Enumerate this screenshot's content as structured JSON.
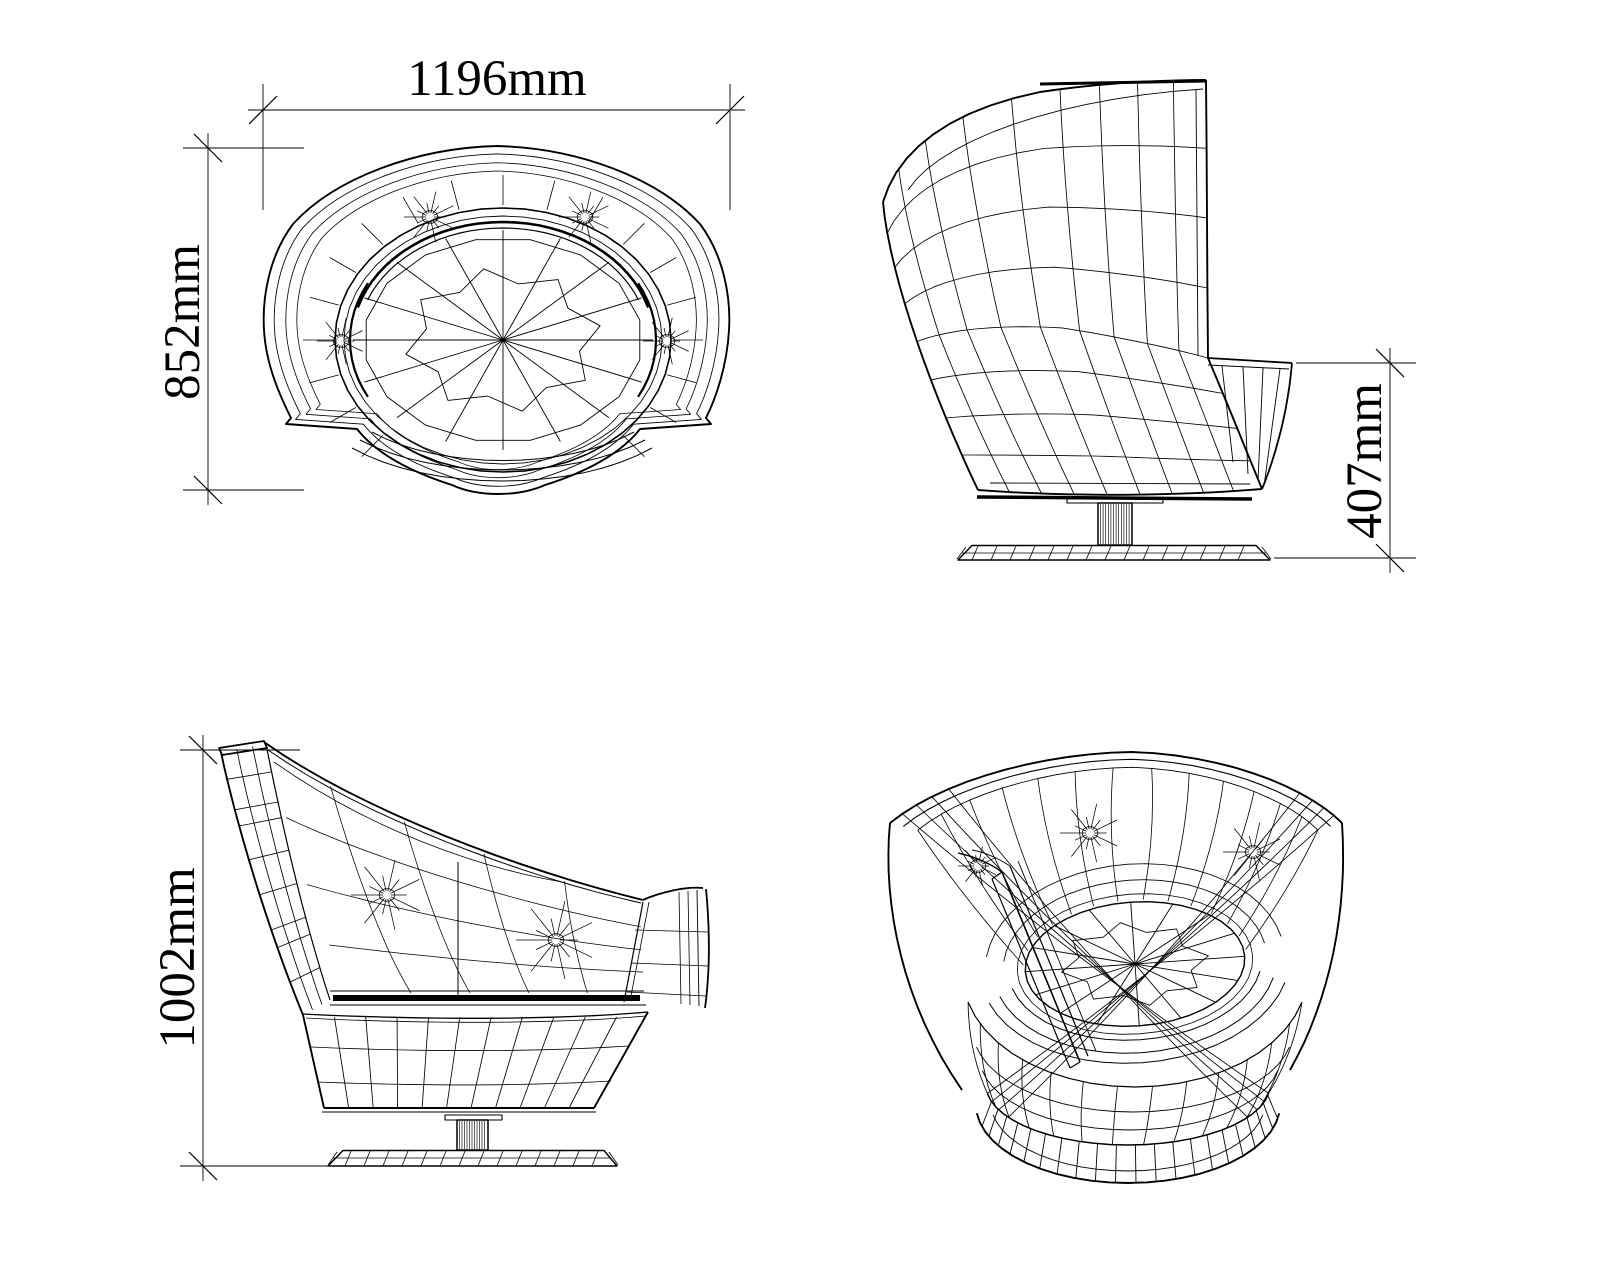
{
  "colors": {
    "background": "#ffffff",
    "stroke": "#000000"
  },
  "dimensions": {
    "width": {
      "label": "1196mm",
      "value_mm": 1196,
      "orientation": "horizontal"
    },
    "depth": {
      "label": "852mm",
      "value_mm": 852,
      "orientation": "vertical"
    },
    "seat_height": {
      "label": "407mm",
      "value_mm": 407,
      "orientation": "vertical"
    },
    "overall_height": {
      "label": "1002mm",
      "value_mm": 1002,
      "orientation": "vertical"
    }
  }
}
